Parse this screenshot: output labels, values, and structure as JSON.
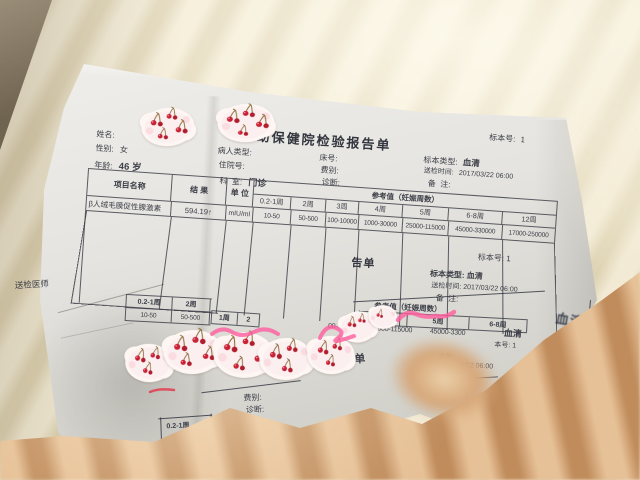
{
  "colors": {
    "ink": "#3e4049",
    "paper": "#e9e8e4",
    "blanket_cream": "#e7ddc2",
    "blanket_tan": "#d5a97e",
    "cherry_red": "#c92235",
    "scribble_pink": "#ff5c9e"
  },
  "report1": {
    "title": "幼保健院检验报告单",
    "fields": {
      "name_label": "姓名:",
      "gender_label": "性别:",
      "gender_value": "女",
      "age_label": "年龄:",
      "age_value": "46 岁",
      "patient_type_label": "病人类型:",
      "admission_label": "住院号:",
      "dept_label": "科  室:",
      "dept_value": "门诊",
      "bed_label": "床号:",
      "fee_label": "费别:",
      "diagnosis_label": "诊断:",
      "specimen_no_label": "标本号:",
      "specimen_no_value": "1",
      "specimen_type_label": "标本类型:",
      "specimen_type_value": "血清",
      "send_time_label": "送检时间:",
      "send_time_value": "2017/03/22 06:00",
      "remark_label": "备  注:"
    },
    "table": {
      "item_header": "项目名称",
      "result_header": "结 果",
      "unit_header": "单 位",
      "ref_header": "参考值（妊娠周数）",
      "week_cols": [
        "0.2-1周",
        "2周",
        "3周",
        "4周",
        "5周",
        "6-8周",
        "12周"
      ],
      "row": {
        "item": "β人绒毛膜促性腺激素",
        "result": "594.19↑",
        "unit": "mIU/ml",
        "refs": [
          "10-50",
          "50-500",
          "100-10000",
          "1000-30000",
          "25000-115000",
          "45000-330000",
          "17000-250000"
        ]
      },
      "doctor_label": "送检医师"
    }
  },
  "report2": {
    "left_table": {
      "week_cols": [
        "0.2-1周",
        "2周"
      ],
      "values": [
        "10-50",
        "50-500"
      ],
      "overlap_cols": [
        "1周",
        "2"
      ]
    },
    "right": {
      "title_fragment": "告单",
      "specimen_no": "标本号: 1",
      "specimen_type": "标本类型: 血清",
      "send_time": "送检时间: 2017/03/22 06:00",
      "remark": "备  注:",
      "ref_header": "参考值（妊娠周数）",
      "week_cols": [
        "4周",
        "5周",
        "6-8周"
      ],
      "values": [
        "00-30000",
        "25000-115000",
        "45000-3300"
      ],
      "serum_overlap": "血清",
      "specimen_fragment": "本号: 1",
      "specimen_fragment2": "本号:",
      "time_fragment": "/03/22 06:00"
    }
  },
  "report3": {
    "type_fragment": "类型:",
    "title_fragment1": "幼保健",
    "patient_type_label": "病人类型:",
    "title_fragment2": "单",
    "fee_label": "费别:",
    "diagnosis_label": "诊断:",
    "week_fragment": "0.2-1周",
    "value_fragment": "10-50"
  },
  "ink_mark": "血清"
}
